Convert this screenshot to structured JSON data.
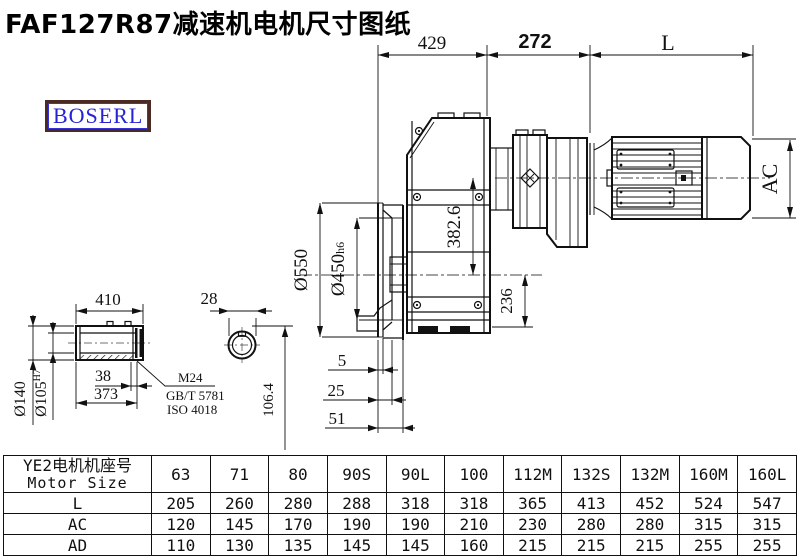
{
  "title": "FAF127R87减速机电机尺寸图纸",
  "logo": {
    "text": "BOSERL"
  },
  "colors": {
    "line": "#111111",
    "logo_text": "#2424d6",
    "logo_border": "#4a2a23"
  },
  "drawing": {
    "top_dims": {
      "left": "429",
      "middle": "272",
      "right": "L"
    },
    "vertical_dims": {
      "motor_height": "AC",
      "axis_offset": "382.6",
      "shaft_to_base": "236",
      "flange_od": "Ø550",
      "flange_pilot": "Ø450",
      "flange_pilot_tol": "h6"
    },
    "flange_dims": {
      "a": "5",
      "b": "25",
      "c": "51"
    },
    "shaft_dims": {
      "length": "410",
      "od": "Ø140",
      "bore": "Ø105",
      "bore_tol": "H7",
      "step": "38",
      "body": "373",
      "key_width": "28",
      "key_height": "106.4"
    },
    "thread_note": {
      "size": "M24",
      "std1": "GB/T 5781",
      "std2": "ISO 4018"
    }
  },
  "table": {
    "header_cn": "YE2电机机座号",
    "header_en": "Motor Size",
    "sizes": [
      "63",
      "71",
      "80",
      "90S",
      "90L",
      "100",
      "112M",
      "132S",
      "132M",
      "160M",
      "160L"
    ],
    "rows": [
      {
        "label": "L",
        "values": [
          "205",
          "260",
          "280",
          "288",
          "318",
          "318",
          "365",
          "413",
          "452",
          "524",
          "547"
        ]
      },
      {
        "label": "AC",
        "values": [
          "120",
          "145",
          "170",
          "190",
          "190",
          "210",
          "230",
          "280",
          "280",
          "315",
          "315"
        ]
      },
      {
        "label": "AD",
        "values": [
          "110",
          "130",
          "135",
          "145",
          "145",
          "160",
          "215",
          "215",
          "215",
          "255",
          "255"
        ]
      }
    ]
  }
}
